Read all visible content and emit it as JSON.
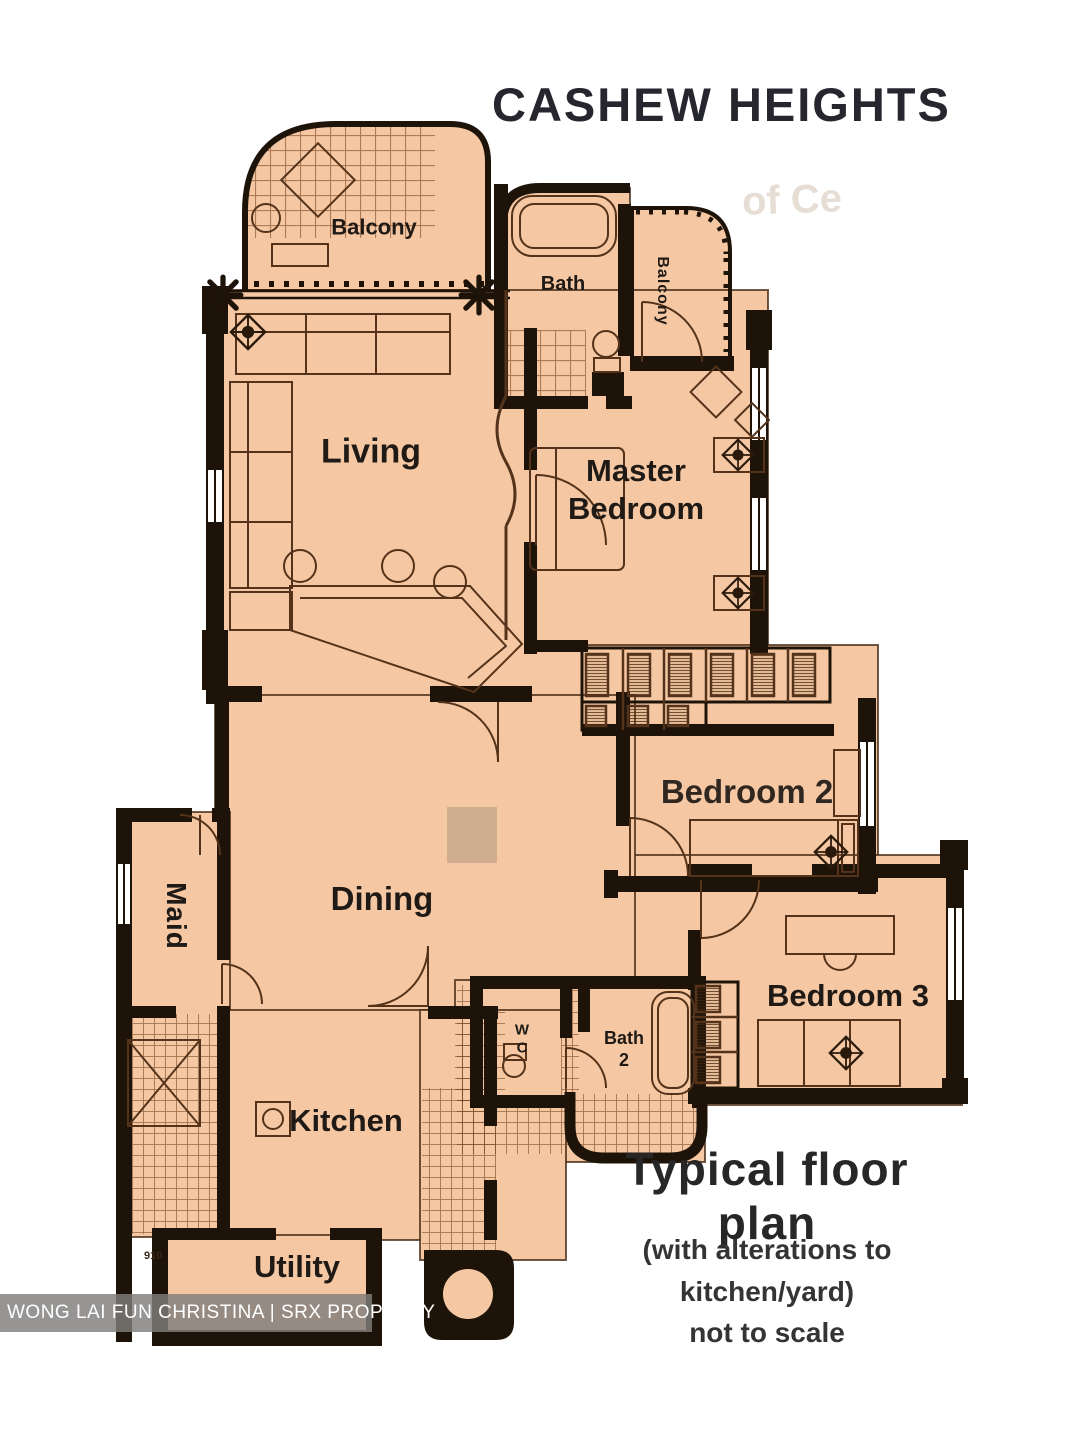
{
  "title": "CASHEW HEIGHTS",
  "plan": {
    "rooms": {
      "balcony_top": "Balcony",
      "bath_top": "Bath",
      "balcony_right": "Balcony",
      "living": "Living",
      "master_bedroom": "Master Bedroom",
      "bedroom2": "Bedroom 2",
      "maid": "Maid",
      "dining": "Dining",
      "bedroom3": "Bedroom 3",
      "kitchen": "Kitchen",
      "wc": "W C",
      "bath2": "Bath 2",
      "utility": "Utility"
    },
    "small_text": "910"
  },
  "caption": {
    "heading": "Typical floor plan",
    "line1": "(with alterations to",
    "line2": "kitchen/yard)",
    "line3": "not to scale"
  },
  "watermark": "WONG LAI FUN CHRISTINA | SRX PROPERTY",
  "ghost_text": "of Ce",
  "colors": {
    "floor": "#f5c8a3",
    "wall": "#1e1309",
    "line": "#54331a",
    "label": "#201a16"
  }
}
